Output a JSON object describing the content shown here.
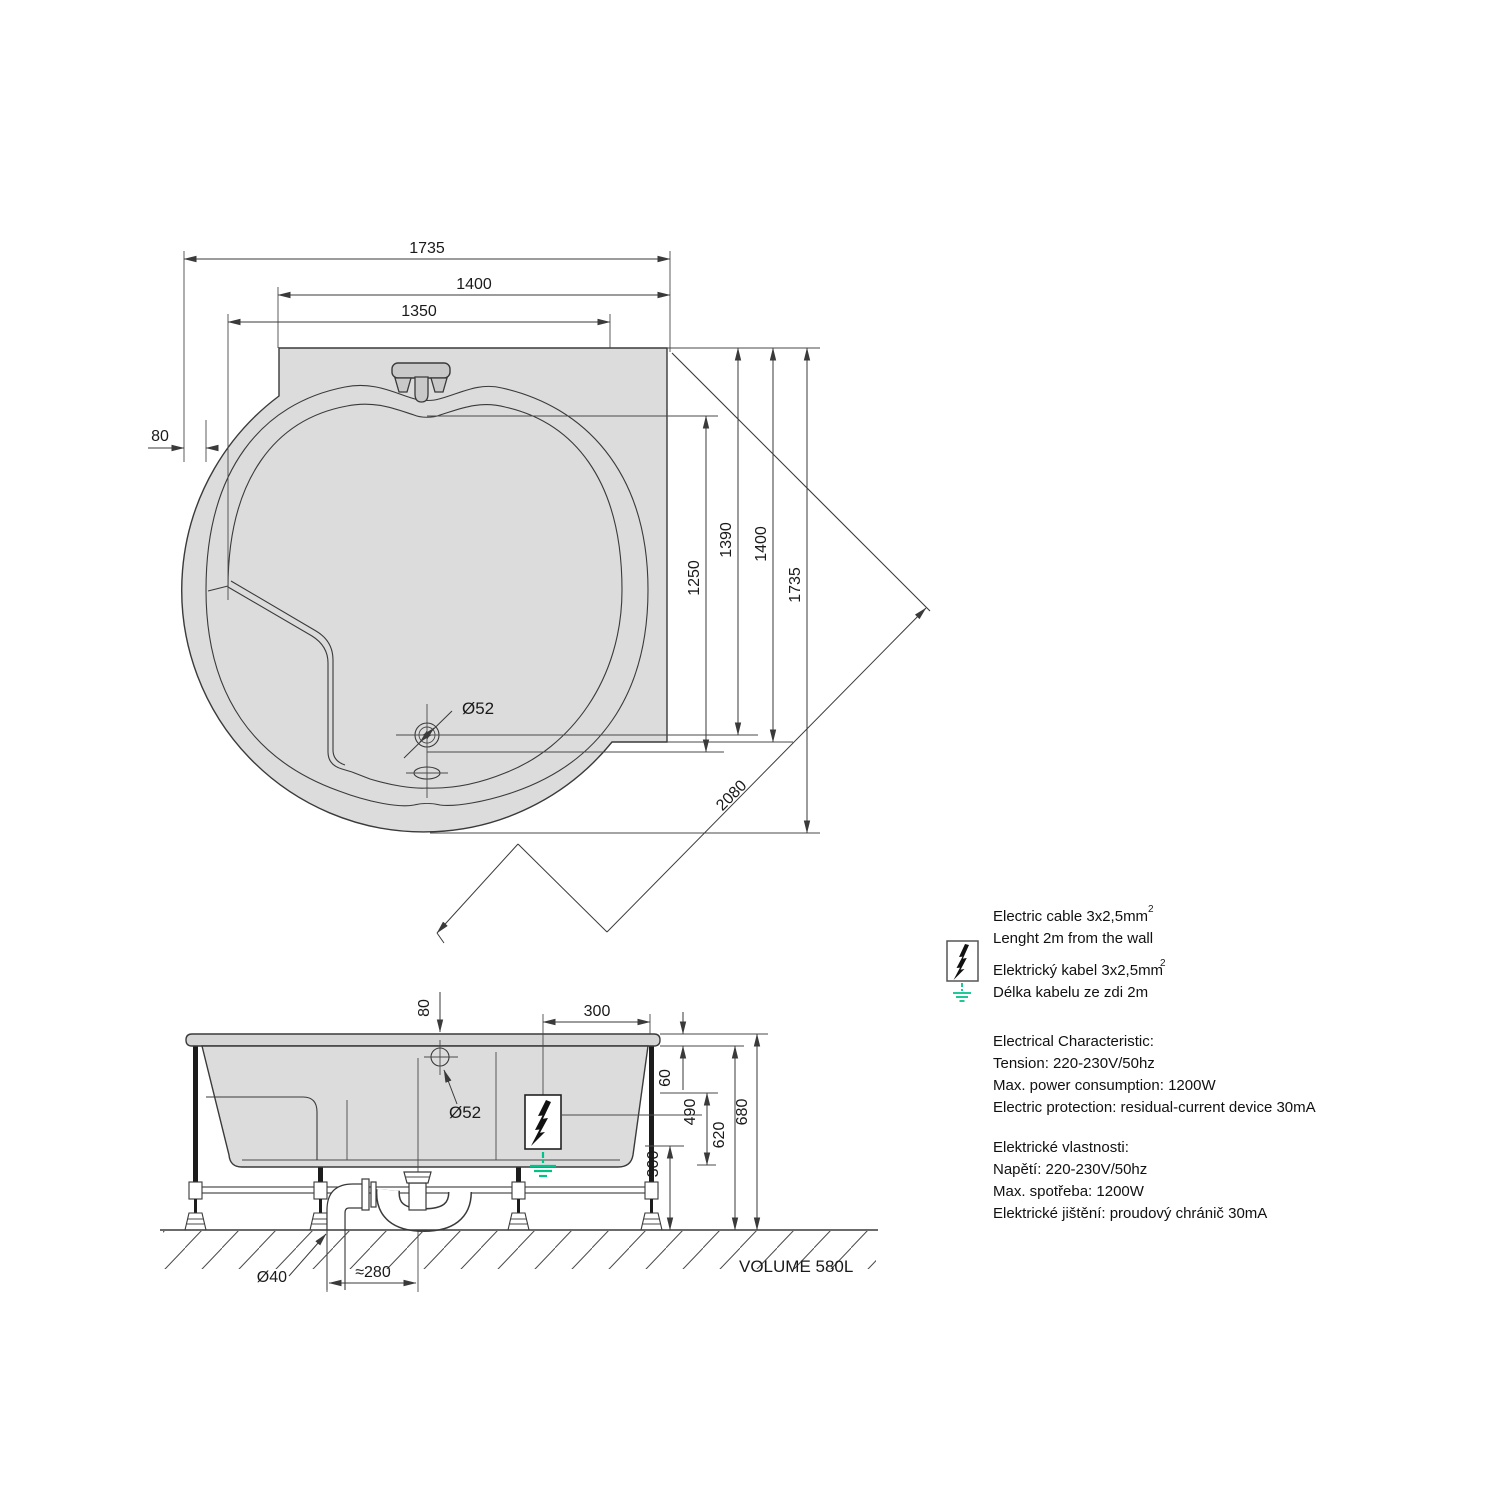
{
  "colors": {
    "line": "#3a3a3a",
    "tub_fill": "#dcdcdc",
    "fixture_fill": "#c9c9c9",
    "ground_green": "#00c389"
  },
  "top_view": {
    "dim_width_outer": "1735",
    "dim_width_1400": "1400",
    "dim_width_1350": "1350",
    "dim_offset_80": "80",
    "dim_h_1250": "1250",
    "dim_h_1390": "1390",
    "dim_h_1400": "1400",
    "dim_h_1735": "1735",
    "dim_diagonal": "2080",
    "label_drain": "Ø52"
  },
  "side_view": {
    "dim_offset_80": "80",
    "dim_top_300": "300",
    "label_overflow": "Ø52",
    "dim_60": "60",
    "dim_490": "490",
    "dim_620": "620",
    "dim_680": "680",
    "dim_300": "300",
    "label_pipe": "Ø40",
    "dim_280": "≈280",
    "volume": "VOLUME 580L"
  },
  "legend": {
    "cable_en": "Electric cable 3x2,5mm",
    "cable_sup": "2",
    "length_en": "Lenght 2m from the wall",
    "cable_cz": "Elektrický kabel 3x2,5mm",
    "length_cz": "Délka kabelu ze zdi 2m",
    "char_en": "Electrical Characteristic:",
    "tension_en": "Tension: 220-230V/50hz",
    "power_en": "Max. power consumption: 1200W",
    "protection_en": "Electric protection: residual-current device 30mA",
    "char_cz": "Elektrické vlastnosti:",
    "tension_cz": "Napětí: 220-230V/50hz",
    "power_cz": "Max. spotřeba: 1200W",
    "protection_cz": "Elektrické jištění: proudový chránič 30mA"
  }
}
